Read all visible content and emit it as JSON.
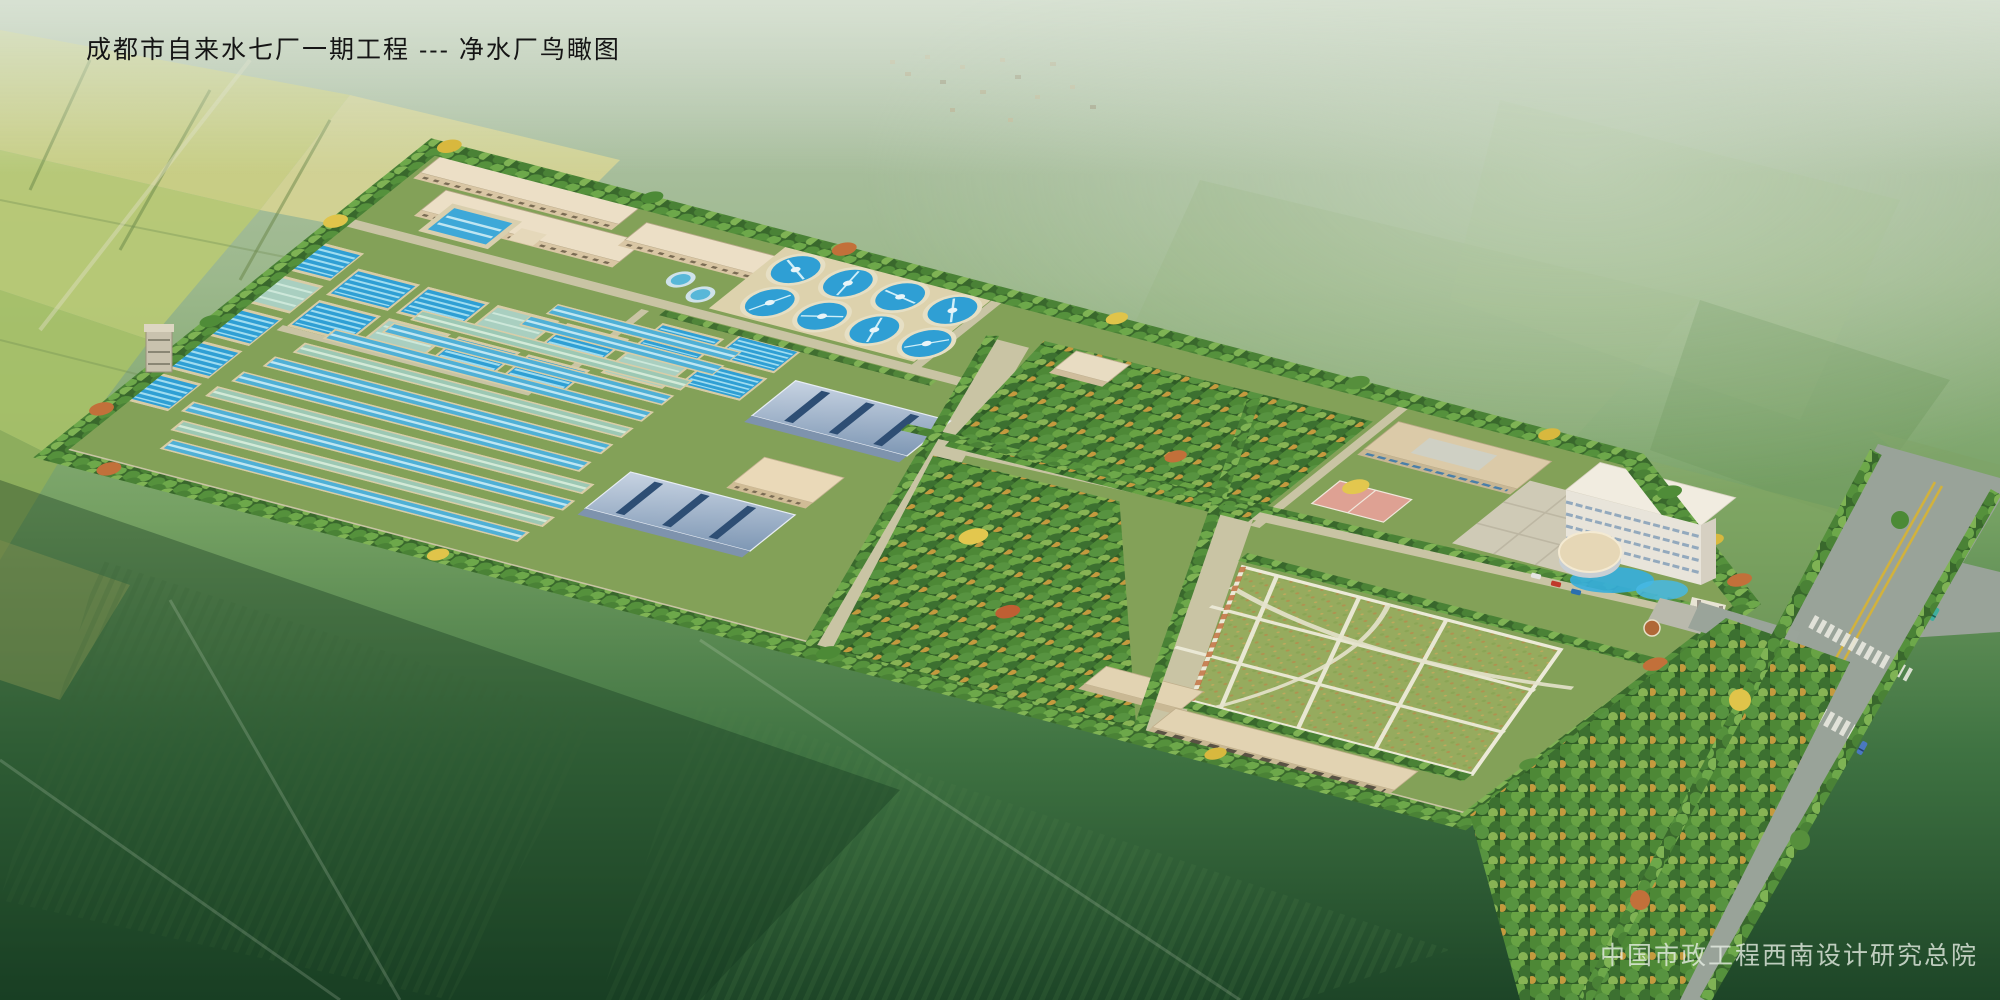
{
  "header": {
    "title": "成都市自来水七厂一期工程 --- 净水厂鸟瞰图"
  },
  "footer": {
    "credit": "中国市政工程西南设计研究总院"
  },
  "palette": {
    "water_blue": "#3aa6d6",
    "metal_roof": "#8fa6c0",
    "tan_roof": "#e9dcc0",
    "hedge_green": "#3c6e2e",
    "highway_gray": "#99a399",
    "site_road_tan": "#c9c4a4",
    "lawn_green": "#9db368",
    "dark_field": "#1d4527",
    "light_field": "#c9ce81"
  },
  "scene": {
    "description": "Aerial architectural rendering of a water purification plant set among farm fields",
    "elements": [
      "workshop-buildings",
      "square-filter-basins",
      "long-sedimentation-lanes",
      "circular-clarifiers",
      "blue-roof-filter-houses",
      "central-woods",
      "lawn-with-paths",
      "office-building",
      "main-administration-building",
      "round-pavilion",
      "sports-court",
      "garage-row",
      "entrance-gate",
      "perimeter-hedge",
      "highway-with-crosswalks",
      "farm-fields",
      "village"
    ]
  }
}
